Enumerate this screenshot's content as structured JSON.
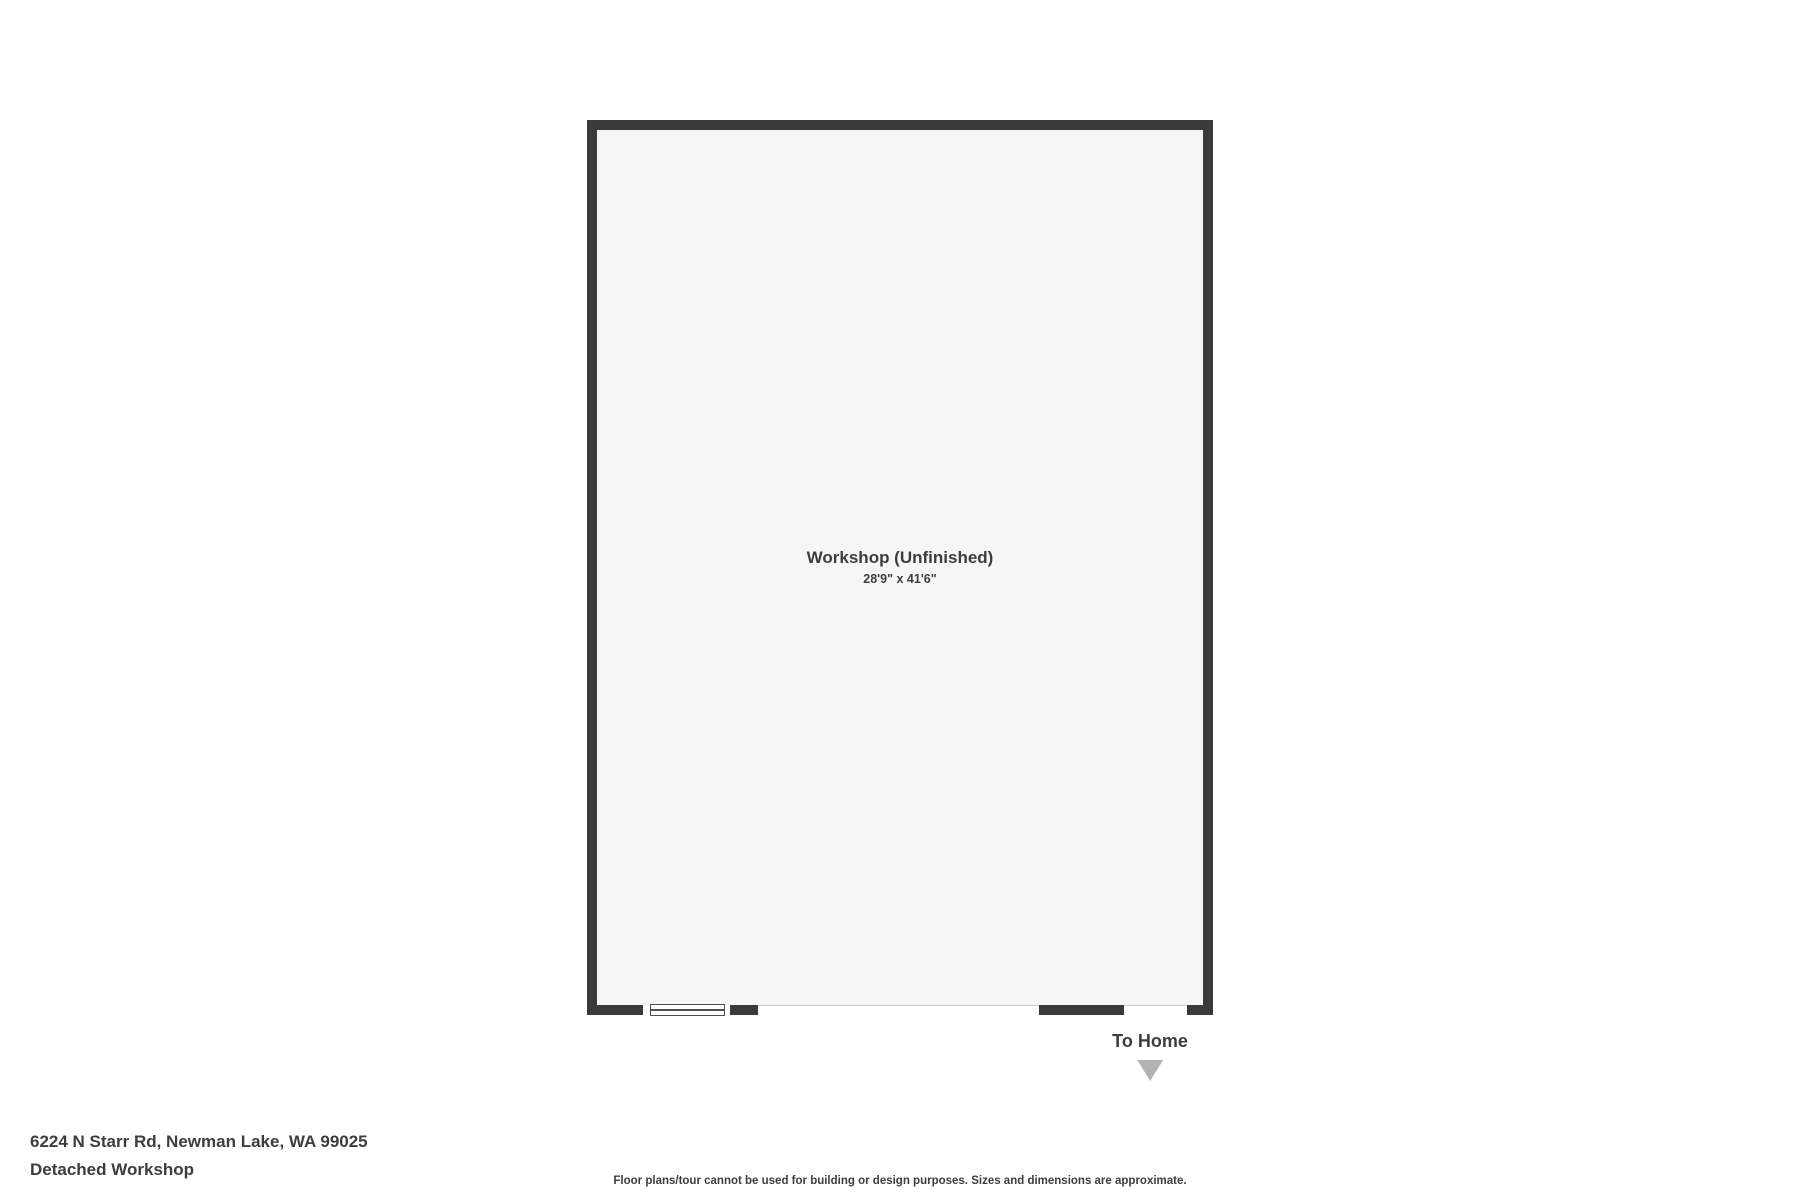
{
  "plan": {
    "room": {
      "name": "Workshop (Unfinished)",
      "dimensions": "28'9\" x 41'6\""
    },
    "to_home_label": "To Home",
    "icons": {
      "to_home_direction": "triangle-down"
    },
    "features": {
      "window_count": 1,
      "opening_count": 2
    }
  },
  "footer": {
    "address": "6224 N Starr Rd, Newman Lake, WA 99025",
    "subtitle": "Detached Workshop",
    "disclaimer": "Floor plans/tour cannot be used for building or design purposes. Sizes and dimensions are approximate."
  },
  "colors": {
    "wall": "#3a3a3a",
    "floor": "#f6f6f6",
    "text": "#3d3d3d",
    "triangle": "#b3b3b3",
    "opening_line": "#c9c9c9",
    "page_background": "#ffffff"
  }
}
